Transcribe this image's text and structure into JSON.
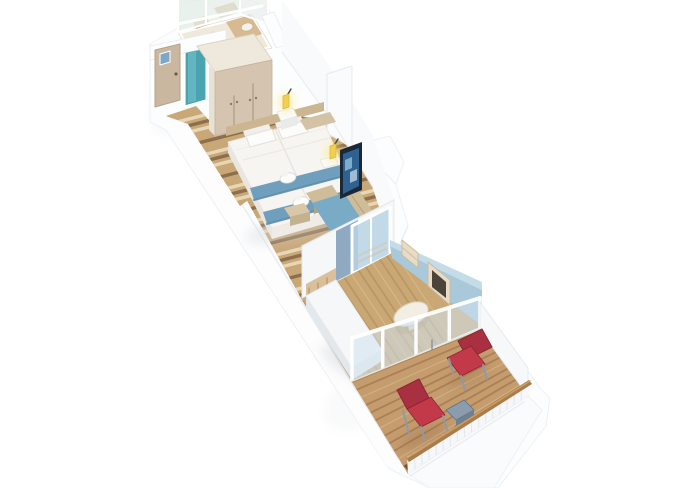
{
  "canvas": {
    "width": 680,
    "height": 488,
    "background": "#ffffff"
  },
  "scene": {
    "type": "isometric-3d-floorplan-render",
    "rooms": [
      {
        "id": "structure",
        "label": "cabin shell walls"
      },
      {
        "id": "bathroom",
        "label": "bathroom"
      },
      {
        "id": "entry",
        "label": "entry corridor"
      },
      {
        "id": "bedroom",
        "label": "bedroom"
      },
      {
        "id": "sitting-area",
        "label": "sitting area"
      },
      {
        "id": "divider",
        "label": "divider wall"
      },
      {
        "id": "second-room",
        "label": "lounge room"
      },
      {
        "id": "balcony",
        "label": "balcony"
      }
    ],
    "furniture": [
      "entrance-door",
      "bathroom-door",
      "shower-glass",
      "sink-counter",
      "toilet",
      "wardrobe",
      "double-bed",
      "pillows",
      "bed-runner",
      "towel-animal",
      "wall-lamp",
      "nightstand",
      "ottoman",
      "sofa",
      "tv",
      "divider-glass-door",
      "daybed",
      "slatted-headboard",
      "wall-shelf-unit",
      "vanity-desk",
      "dining-table",
      "balcony-glass-partition",
      "deck-chair",
      "balcony-table",
      "balcony-railing"
    ]
  },
  "palette": {
    "bg": "#ffffff",
    "wallWhite": "#fcfdfe",
    "wallShade": "#f2f4f6",
    "wallEdge": "#e7ebee",
    "wallDeep": "#dde2e6",
    "bathFloor": "#efe9db",
    "fixtureTan": "#d8ba92",
    "fixtureTan2": "#cfa87a",
    "fixtureCream": "#e8dcc8",
    "porcelain": "#f5f2ea",
    "glassGreen": "#e4ede7",
    "glassBlue": "#cfe2ee",
    "glassDoor": "#b9d4e4",
    "tealDoor": "#49a3b0",
    "tealLight": "#6fbcc6",
    "entryDoor": "#c9b7a0",
    "plaqueBlue": "#7da6c8",
    "wardrobe": "#d5c5b0",
    "wardrobeSeam": "#b2a28b",
    "wardrobeTop": "#efe9dd",
    "floorDark": "#8a6a4b",
    "floorMid": "#c9a878",
    "floorLight": "#ead9bb",
    "floor2": "#c9a876",
    "floor2Dark": "#ab8752",
    "floor2Light": "#e2c694",
    "deck": "#c49c6e",
    "deckDark": "#96693f",
    "deckLight": "#dcc096",
    "deckTrim": "#7c4e2a",
    "headboard": "#cbb691",
    "bedWhite": "#f7f5f2",
    "bedShade": "#e9e6e0",
    "pillow": "#fcfcfb",
    "runner": "#6f9fbc",
    "runnerDark": "#5d8cab",
    "benchTan": "#d3c2a4",
    "ottoman": "#d9c8a8",
    "ottomanDark": "#c4b190",
    "sofa": "#79abc6",
    "sofaDark": "#5f93b2",
    "cushion": "#cfbd99",
    "cushionDark": "#b8a37c",
    "tvFrame": "#1b2838",
    "tvScreen": "#2f6191",
    "tvLight": "#8fc0dc",
    "lampYellow": "#f2cf4e",
    "lampGlow": "#ffe98a",
    "lampStem": "#4a4a4a",
    "dividerBlue": "#8ea9c1",
    "wallBlue": "#a9c8da",
    "wallBlueLight": "#c4dbe8",
    "unitCream": "#e8dcc6",
    "unitShadow": "#cdbba0",
    "screenDark": "#4a443b",
    "bed2": "#f5f7f8",
    "bed2Shade": "#e3e8ec",
    "slats": "#d9c09a",
    "slatDark": "#a8885f",
    "tableTop": "#f2eee3",
    "tableEdge": "#d9d2c0",
    "chairRed": "#a93040",
    "chairRedLight": "#c23a4a",
    "chairRedDark": "#8c2634",
    "chairFrame": "#8d9aa8",
    "btable": "#8a9cae",
    "btableDark": "#6e8092",
    "railCap": "#aa7c4a",
    "railCapLight": "#cfa36c",
    "shadow": "#dfe5e9",
    "deckShadow": "#8a6038"
  }
}
